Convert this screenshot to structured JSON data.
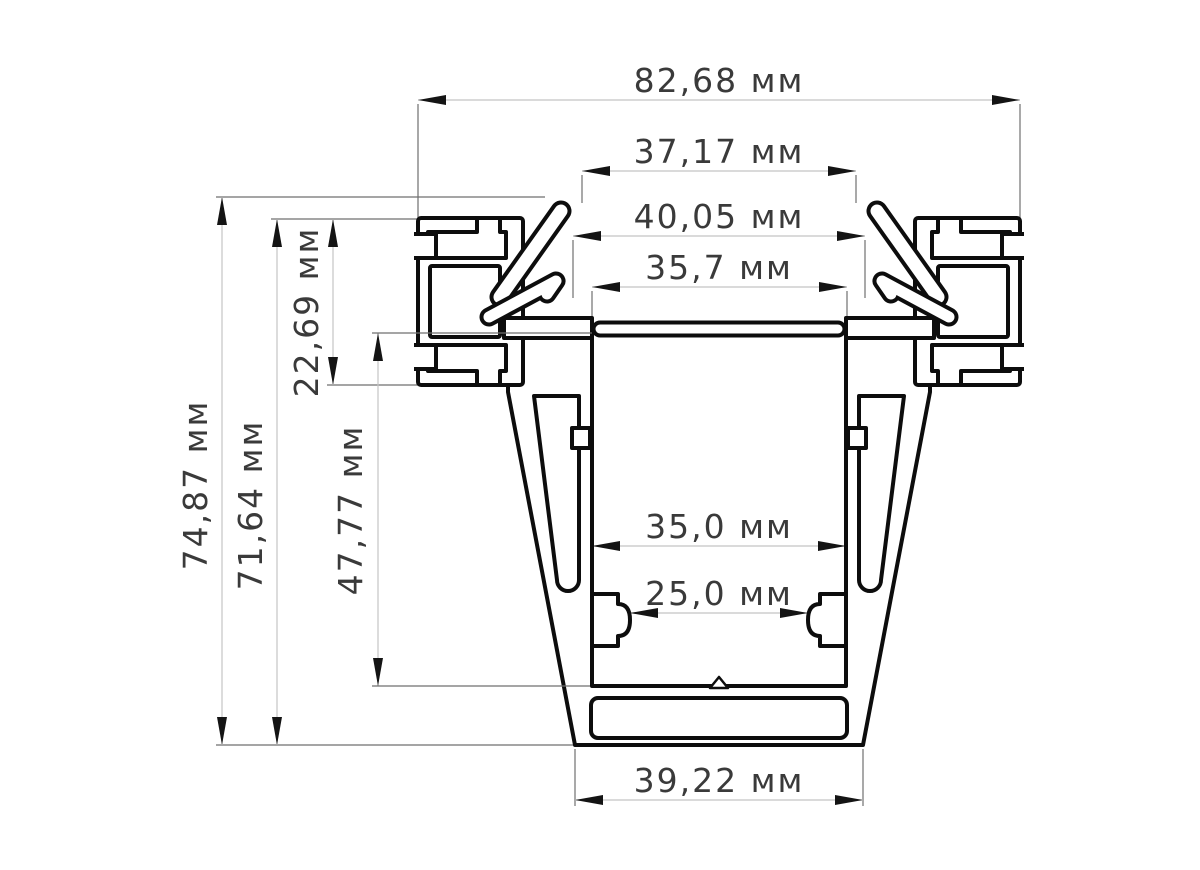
{
  "drawing": {
    "type": "aluminium-profile-cross-section",
    "unit": "мм",
    "dimensions": {
      "overall_width": {
        "value": 82.68,
        "label": "82,68 мм"
      },
      "tip_span": {
        "value": 37.17,
        "label": "37,17 мм"
      },
      "hook_span": {
        "value": 40.05,
        "label": "40,05 мм"
      },
      "top_opening": {
        "value": 35.7,
        "label": "35,7 мм"
      },
      "overall_height": {
        "value": 74.87,
        "label": "74,87 мм"
      },
      "body_height": {
        "value": 71.64,
        "label": "71,64 мм"
      },
      "flange_height": {
        "value": 22.69,
        "label": "22,69 мм"
      },
      "cavity_depth": {
        "value": 47.77,
        "label": "47,77 мм"
      },
      "cavity_width": {
        "value": 35.0,
        "label": "35,0 мм"
      },
      "slot_opening": {
        "value": 25.0,
        "label": "25,0 мм"
      },
      "bottom_width": {
        "value": 39.22,
        "label": "39,22 мм"
      }
    },
    "colors": {
      "line": "#0d0d0d",
      "dimension_line": "#c4c4c4",
      "extension_line": "#6f6f6f",
      "text": "#3a3a3a",
      "background": "#ffffff"
    }
  }
}
